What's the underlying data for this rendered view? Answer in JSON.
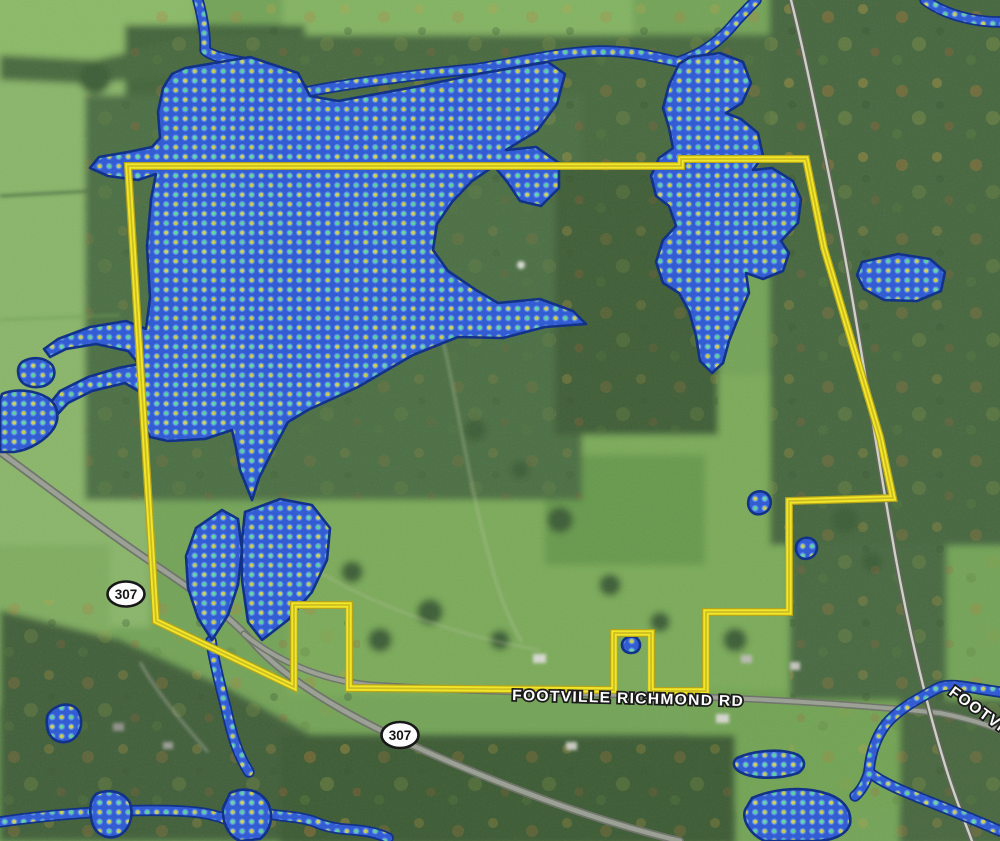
{
  "map": {
    "view_type": "satellite-imagery",
    "route_shields": [
      {
        "label": "307"
      },
      {
        "label": "307"
      }
    ],
    "road_labels": [
      {
        "text": "FOOTVILLE RICHMOND RD"
      },
      {
        "text": "FOOTVI"
      }
    ],
    "overlays": {
      "parcel_boundary_color": "#f4e824",
      "wetland": {
        "fill": "#2e59d4",
        "outline": "#0b2d86",
        "dot_green": "#64d6a4",
        "dot_yellow": "#ccd15c"
      }
    }
  }
}
